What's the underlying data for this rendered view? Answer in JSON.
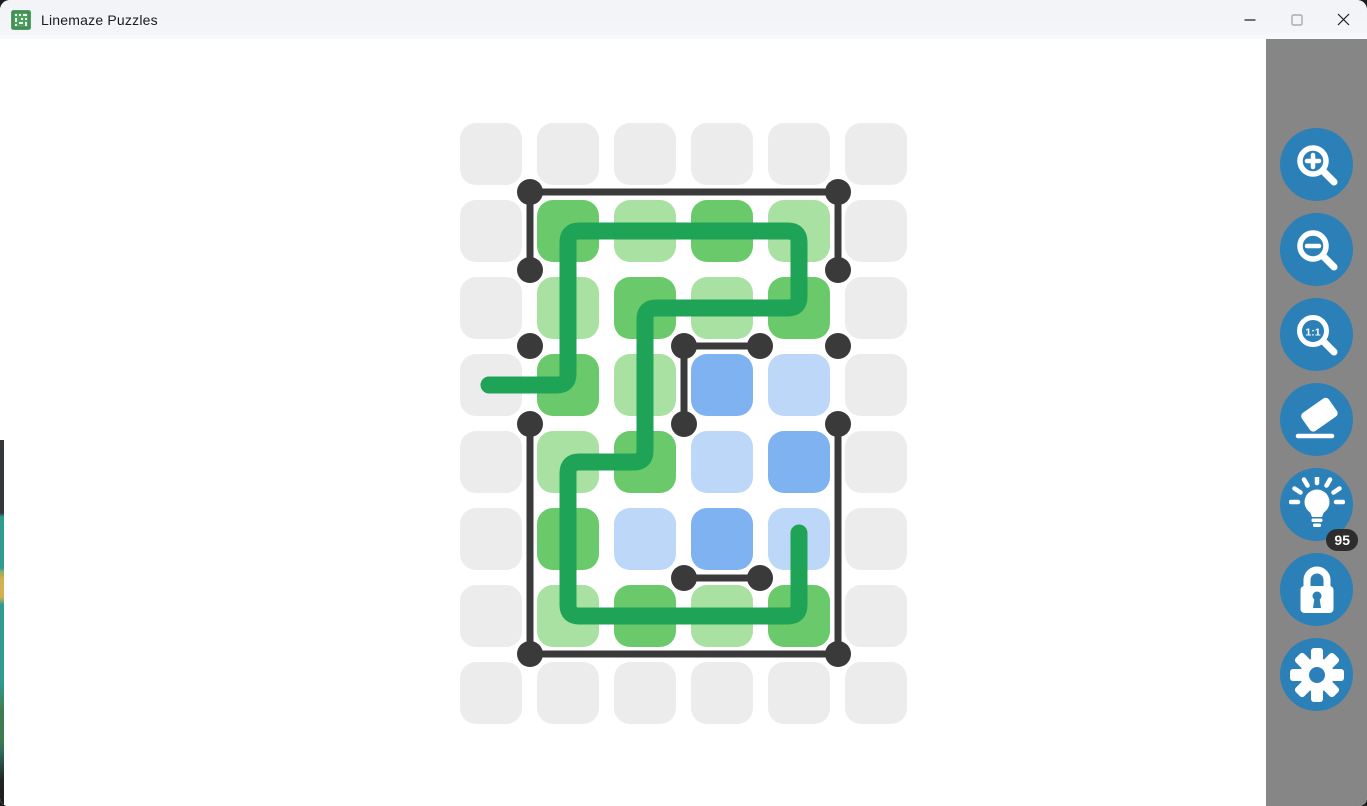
{
  "window": {
    "title": "Linemaze Puzzles",
    "controls": {
      "minimize": "minimize",
      "maximize": "maximize",
      "close": "close"
    }
  },
  "sidebar": {
    "background": "#868686",
    "button_color": "#2b80b8",
    "zoom_actual_label": "1:1",
    "hint_badge": "95",
    "buttons": [
      {
        "id": "zoom-in",
        "icon": "magnifier-plus-icon"
      },
      {
        "id": "zoom-out",
        "icon": "magnifier-minus-icon"
      },
      {
        "id": "zoom-actual",
        "icon": "magnifier-1-1-icon"
      },
      {
        "id": "eraser",
        "icon": "eraser-icon"
      },
      {
        "id": "hint",
        "icon": "lightbulb-icon",
        "badge": "95"
      },
      {
        "id": "lock",
        "icon": "padlock-icon"
      },
      {
        "id": "settings",
        "icon": "gear-icon"
      }
    ]
  },
  "puzzle": {
    "grid": {
      "cols": 6,
      "rows": 8,
      "origin_x": 460,
      "origin_y": 123,
      "cell_size": 62,
      "pitch": 77,
      "corner_radius": 16
    },
    "cell_colors": {
      "gray": "#ececec",
      "green_dark": "#6aca6b",
      "green_light": "#a9e1a2",
      "blue_dark": "#7fb2f0",
      "blue_light": "#bdd7f8"
    },
    "cells": [
      [
        "gray",
        "gray",
        "gray",
        "gray",
        "gray",
        "gray"
      ],
      [
        "gray",
        "green_dark",
        "green_light",
        "green_dark",
        "green_light",
        "gray"
      ],
      [
        "gray",
        "green_light",
        "green_dark",
        "green_light",
        "green_dark",
        "gray"
      ],
      [
        "gray",
        "green_dark",
        "green_light",
        "blue_dark",
        "blue_light",
        "gray"
      ],
      [
        "gray",
        "green_light",
        "green_dark",
        "blue_light",
        "blue_dark",
        "gray"
      ],
      [
        "gray",
        "green_dark",
        "blue_light",
        "blue_dark",
        "blue_light",
        "gray"
      ],
      [
        "gray",
        "green_light",
        "green_dark",
        "green_light",
        "green_dark",
        "gray"
      ],
      [
        "gray",
        "gray",
        "gray",
        "gray",
        "gray",
        "gray"
      ]
    ],
    "walls": {
      "color": "#3a3a3a",
      "thickness": 7,
      "dot_radius": 13,
      "segments": [
        [
          530,
          192,
          838,
          192
        ],
        [
          530,
          192,
          530,
          270
        ],
        [
          838,
          192,
          838,
          270
        ],
        [
          684,
          346,
          760,
          346
        ],
        [
          684,
          346,
          684,
          424
        ],
        [
          530,
          424,
          530,
          654
        ],
        [
          838,
          424,
          838,
          654
        ],
        [
          530,
          654,
          838,
          654
        ],
        [
          684,
          578,
          760,
          578
        ]
      ],
      "dots": [
        [
          530,
          192
        ],
        [
          838,
          192
        ],
        [
          530,
          270
        ],
        [
          838,
          270
        ],
        [
          530,
          346
        ],
        [
          684,
          346
        ],
        [
          760,
          346
        ],
        [
          838,
          346
        ],
        [
          530,
          424
        ],
        [
          684,
          424
        ],
        [
          838,
          424
        ],
        [
          684,
          578
        ],
        [
          760,
          578
        ],
        [
          530,
          654
        ],
        [
          838,
          654
        ]
      ]
    },
    "path": {
      "color": "#1fa357",
      "thickness": 17,
      "corner_radius": 11,
      "points": [
        [
          489,
          385
        ],
        [
          568,
          385
        ],
        [
          568,
          231
        ],
        [
          799,
          231
        ],
        [
          799,
          308
        ],
        [
          645,
          308
        ],
        [
          645,
          462
        ],
        [
          568,
          462
        ],
        [
          568,
          616
        ],
        [
          799,
          616
        ],
        [
          799,
          533
        ]
      ]
    }
  }
}
